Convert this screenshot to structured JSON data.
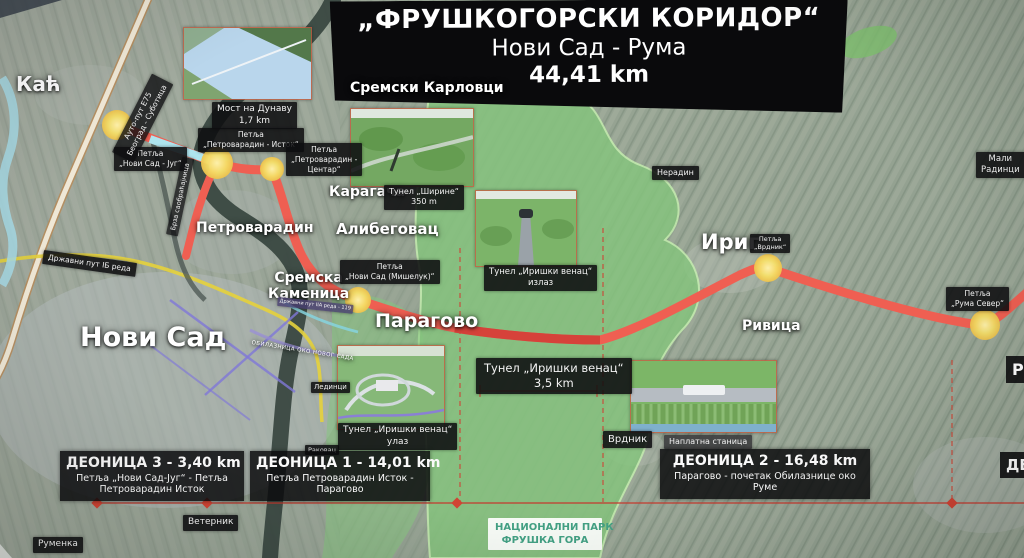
{
  "title": {
    "line1": "„ФРУШКОГОРСКИ КОРИДОР“",
    "line2": "Нови Сад - Рума",
    "line3": "44,41 km"
  },
  "places": {
    "kac": "Каћ",
    "sremski_karlovci": "Сремски Карловци",
    "petrovaradin": "Петроварадин",
    "karagaca": "Карагача",
    "alibegovac": "Алибеговац",
    "sremska_kamenica_1": "Сремска",
    "sremska_kamenica_2": "Каменица",
    "novi_sad": "Нови Сад",
    "paragovo": "Парагово",
    "irig": "Ириг",
    "rivica": "Ривица",
    "neradin": "Нерадин",
    "vrdnik": "Врдник",
    "mali_radinci": "Мали Радинци",
    "ledinci": "Лединци",
    "rakovac": "Раковац",
    "veternik": "Ветерник",
    "rumenka": "Руменка"
  },
  "interchanges": {
    "ns_jug": {
      "l1": "Петља",
      "l2": "„Нови Сад - Југ“"
    },
    "pv_istok": {
      "l1": "Петља",
      "l2": "„Петроварадин - Исток“"
    },
    "pv_centar": {
      "l1": "Петља",
      "l2": "„Петроварадин -",
      "l3": "Центар“"
    },
    "miseluk": {
      "l1": "Петља",
      "l2": "„Нови Сад (Мишелук)“"
    },
    "vrdnik": {
      "l1": "Петља",
      "l2": "„Врдник“"
    },
    "ruma_sever": {
      "l1": "Петља",
      "l2": "„Рума Север“"
    }
  },
  "structures": {
    "bridge": {
      "l1": "Мост на Дунаву",
      "l2": "1,7 km"
    },
    "tunnel_sirine": {
      "l1": "Тунел „Ширине“",
      "l2": "350 m"
    },
    "tunnel_iv_exit": {
      "l1": "Тунел „Иришки венац“",
      "l2": "излаз"
    },
    "tunnel_iv": {
      "l1": "Тунел „Иришки венац“",
      "l2": "3,5 km"
    },
    "tunnel_iv_entrance": {
      "l1": "Тунел „Иришки венац“",
      "l2": "улаз"
    },
    "toll": "Наплатна станица"
  },
  "roads": {
    "e75_l1": "Ауто-пут Е75",
    "e75_l2": "Београд - Суботица",
    "drzavni_ib": "Државни пут IБ реда",
    "drzavni_119": "Државни пут IIА реда - 119",
    "brza": "Брза саобраћајница",
    "obilaznica": "ОБИЛАЗНИЦА ОКО НОВОГ САДА"
  },
  "sections": {
    "d3": {
      "title": "ДЕОНИЦА 3 - 3,40 km",
      "sub1": "Петља „Нови Сад-Југ“ - Петља",
      "sub2": "Петроварадин Исток"
    },
    "d1": {
      "title": "ДЕОНИЦА 1 - 14,01 km",
      "sub1": "Петља Петроварадин Исток -",
      "sub2": "Парагово"
    },
    "d2": {
      "title": "ДЕОНИЦА 2 - 16,48 km",
      "sub1": "Парагово - почетак Обилазнице око",
      "sub2": "Руме"
    }
  },
  "park_label": {
    "l1": "НАЦИОНАЛНИ ПАРК",
    "l2": "ФРУШКА ГОРА"
  },
  "edge_labels": {
    "top": "Р",
    "bottom": "ДЕ"
  },
  "colors": {
    "route": "#ef5f52",
    "route_tunnel": "#d6423a",
    "node_fill": "#f2d95e",
    "park_green": "#85c57d",
    "label_bg": "#0e0e10",
    "board_bg": "#0a0a0c",
    "park_text": "#43a184",
    "section_line": "#c43c30"
  }
}
